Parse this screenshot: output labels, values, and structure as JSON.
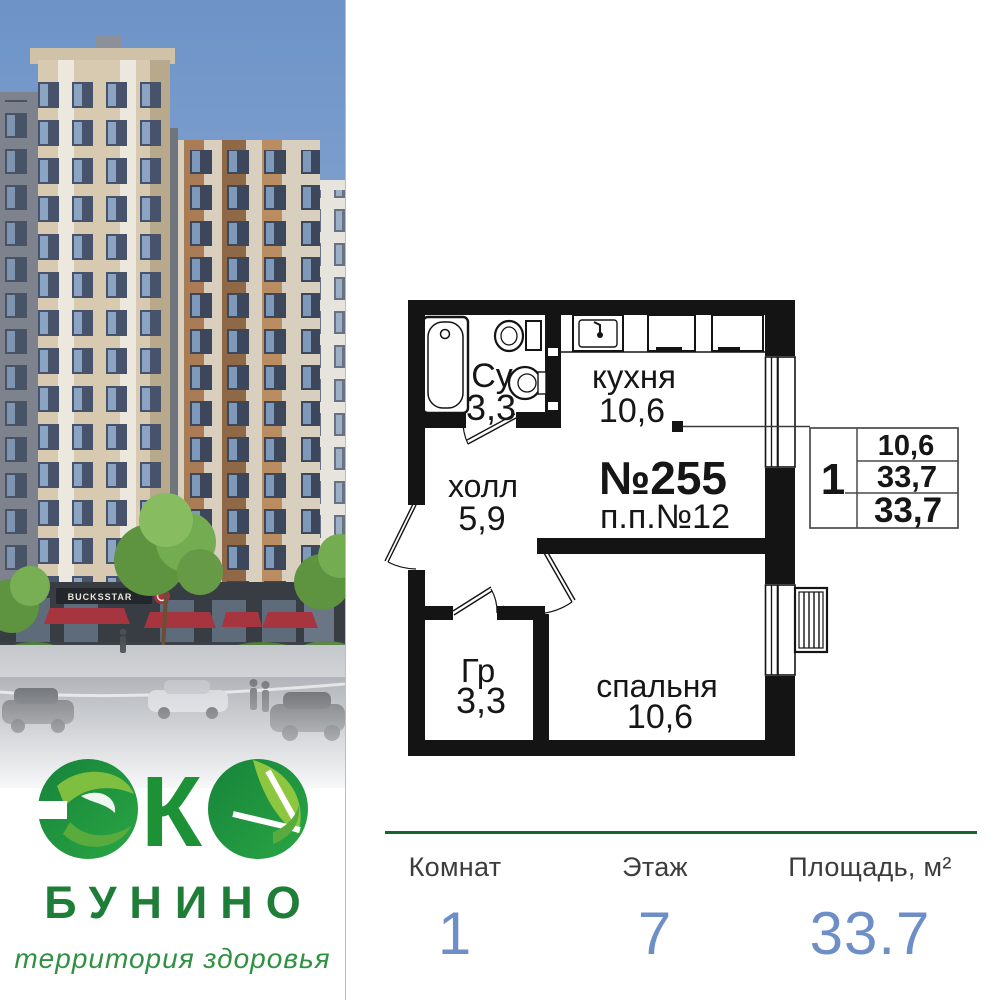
{
  "brand": {
    "eco_k": "К",
    "name": "БУНИНО",
    "tagline": "территория здоровья",
    "storefront_sign": "BUCKSSTAR"
  },
  "floor_plan": {
    "apartment_number": "№255",
    "project_number": "п.п.№12",
    "rooms": {
      "bathroom": {
        "name": "Су",
        "area": "3,3"
      },
      "kitchen": {
        "name": "кухня",
        "area": "10,6"
      },
      "hall": {
        "name": "холл",
        "area": "5,9"
      },
      "wardrobe": {
        "name": "Гр",
        "area": "3,3"
      },
      "bedroom": {
        "name": "спальня",
        "area": "10,6"
      }
    },
    "info_table": {
      "rooms": "1",
      "living_area": "10,6",
      "total_area": "33,7",
      "full_area": "33,7"
    }
  },
  "stats": {
    "columns": [
      {
        "label": "Комнат",
        "value": "1"
      },
      {
        "label": "Этаж",
        "value": "7"
      },
      {
        "label": "Площадь, м²",
        "value": "33.7"
      }
    ]
  },
  "colors": {
    "accent_green": "#14672a",
    "logo_green": "#1d9136",
    "leaf_green": "#8dc63f",
    "value_blue": "#6e8ec8",
    "plan_ink": "#141414",
    "sky_blue": "#6d93c7"
  }
}
